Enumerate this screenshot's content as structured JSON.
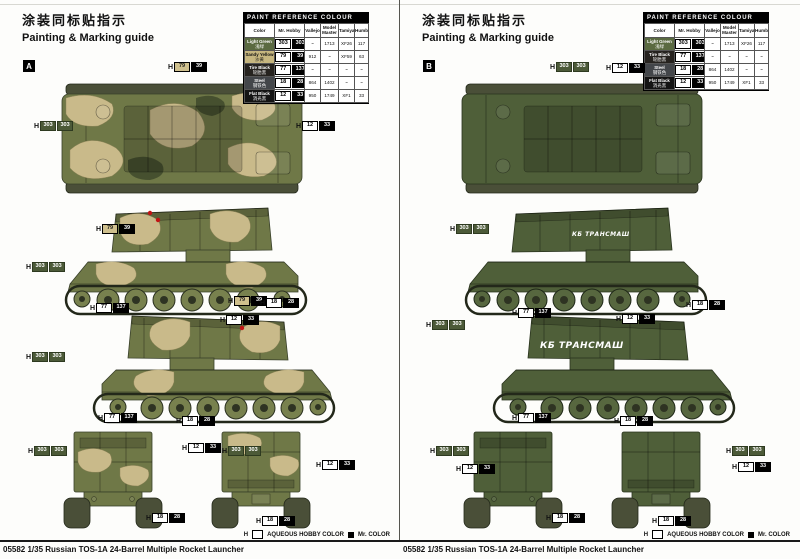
{
  "header": {
    "title_zh": "涂装同标贴指示",
    "title_en": "Painting & Marking guide"
  },
  "footer": {
    "product_title": "05582 1/35 Russian TOS-1A 24-Barrel Multiple Rocket Launcher"
  },
  "legend": {
    "h_prefix": "H",
    "aqueous": "AQUEOUS HOBBY COLOR",
    "mr_color": "Mr. COLOR"
  },
  "paint_table": {
    "title": "PAINT  REFERENCE  COLOUR",
    "columns": [
      "Color",
      "Mr. Hobby",
      "Vallejo",
      "Model Master",
      "Tamiya",
      "Humbrol"
    ]
  },
  "pages": [
    {
      "label": "A",
      "hull_text": "",
      "rows": [
        {
          "color_en": "Light Green",
          "color_zh": "浅绿",
          "swatch": "#5a6a41",
          "aq": "303",
          "mc": "303",
          "vallejo": "~",
          "model_master": "1713",
          "tamiya": "XF26",
          "humbrol": "117"
        },
        {
          "color_en": "Sandy Yellow",
          "color_zh": "沙黄",
          "swatch": "#c6b67f",
          "aq": "79",
          "mc": "39",
          "vallejo": "912",
          "model_master": "~",
          "tamiya": "XF59",
          "humbrol": "63"
        },
        {
          "color_en": "Tire Black",
          "color_zh": "轮胎黑",
          "swatch": "#26231f",
          "aq": "77",
          "mc": "137",
          "vallejo": "~",
          "model_master": "~",
          "tamiya": "~",
          "humbrol": "~"
        },
        {
          "color_en": "Steel",
          "color_zh": "钢铁色",
          "swatch": "#43464a",
          "aq": "18",
          "mc": "28",
          "vallejo": "864",
          "model_master": "1402",
          "tamiya": "~",
          "humbrol": "~"
        },
        {
          "color_en": "Flat Black",
          "color_zh": "消光黑",
          "swatch": "#141414",
          "aq": "12",
          "mc": "33",
          "vallejo": "950",
          "model_master": "1749",
          "tamiya": "XF1",
          "humbrol": "33"
        }
      ],
      "callouts": [
        {
          "aq": "79",
          "mc": "39",
          "x": 168,
          "y": 62
        },
        {
          "aq": "303",
          "mc": "303",
          "x": 34,
          "y": 121
        },
        {
          "aq": "12",
          "mc": "33",
          "x": 296,
          "y": 121
        },
        {
          "aq": "79",
          "mc": "39",
          "x": 96,
          "y": 224
        },
        {
          "aq": "303",
          "mc": "303",
          "x": 26,
          "y": 262
        },
        {
          "aq": "77",
          "mc": "137",
          "x": 90,
          "y": 303
        },
        {
          "aq": "79",
          "mc": "39",
          "x": 228,
          "y": 296
        },
        {
          "aq": "18",
          "mc": "28",
          "x": 260,
          "y": 298
        },
        {
          "aq": "12",
          "mc": "33",
          "x": 220,
          "y": 315
        },
        {
          "aq": "303",
          "mc": "303",
          "x": 26,
          "y": 352
        },
        {
          "aq": "77",
          "mc": "137",
          "x": 98,
          "y": 413
        },
        {
          "aq": "18",
          "mc": "28",
          "x": 176,
          "y": 416
        },
        {
          "aq": "303",
          "mc": "303",
          "x": 28,
          "y": 446
        },
        {
          "aq": "12",
          "mc": "33",
          "x": 182,
          "y": 443
        },
        {
          "aq": "18",
          "mc": "28",
          "x": 146,
          "y": 513
        },
        {
          "aq": "303",
          "mc": "303",
          "x": 222,
          "y": 446
        },
        {
          "aq": "12",
          "mc": "33",
          "x": 316,
          "y": 460
        },
        {
          "aq": "18",
          "mc": "28",
          "x": 256,
          "y": 516
        }
      ]
    },
    {
      "label": "B",
      "hull_text": "КБ ТРАНСМАШ",
      "rows": [
        {
          "color_en": "Light Green",
          "color_zh": "浅绿",
          "swatch": "#5a6a41",
          "aq": "303",
          "mc": "303",
          "vallejo": "~",
          "model_master": "1713",
          "tamiya": "XF26",
          "humbrol": "117"
        },
        {
          "color_en": "Tire Black",
          "color_zh": "轮胎黑",
          "swatch": "#26231f",
          "aq": "77",
          "mc": "137",
          "vallejo": "~",
          "model_master": "~",
          "tamiya": "~",
          "humbrol": "~"
        },
        {
          "color_en": "Steel",
          "color_zh": "钢铁色",
          "swatch": "#43464a",
          "aq": "18",
          "mc": "28",
          "vallejo": "864",
          "model_master": "1402",
          "tamiya": "~",
          "humbrol": "~"
        },
        {
          "color_en": "Flat Black",
          "color_zh": "消光黑",
          "swatch": "#141414",
          "aq": "12",
          "mc": "33",
          "vallejo": "950",
          "model_master": "1749",
          "tamiya": "XF1",
          "humbrol": "33"
        }
      ],
      "callouts": [
        {
          "aq": "303",
          "mc": "303",
          "x": 150,
          "y": 62
        },
        {
          "aq": "12",
          "mc": "33",
          "x": 206,
          "y": 63
        },
        {
          "aq": "303",
          "mc": "303",
          "x": 50,
          "y": 224
        },
        {
          "aq": "77",
          "mc": "137",
          "x": 112,
          "y": 308
        },
        {
          "aq": "18",
          "mc": "28",
          "x": 286,
          "y": 300
        },
        {
          "aq": "303",
          "mc": "303",
          "x": 26,
          "y": 320
        },
        {
          "aq": "12",
          "mc": "33",
          "x": 216,
          "y": 314
        },
        {
          "aq": "77",
          "mc": "137",
          "x": 112,
          "y": 413
        },
        {
          "aq": "18",
          "mc": "28",
          "x": 214,
          "y": 416
        },
        {
          "aq": "303",
          "mc": "303",
          "x": 30,
          "y": 446
        },
        {
          "aq": "12",
          "mc": "33",
          "x": 56,
          "y": 464
        },
        {
          "aq": "18",
          "mc": "28",
          "x": 146,
          "y": 513
        },
        {
          "aq": "303",
          "mc": "303",
          "x": 326,
          "y": 446
        },
        {
          "aq": "12",
          "mc": "33",
          "x": 332,
          "y": 462
        },
        {
          "aq": "18",
          "mc": "28",
          "x": 252,
          "y": 516
        }
      ]
    }
  ]
}
